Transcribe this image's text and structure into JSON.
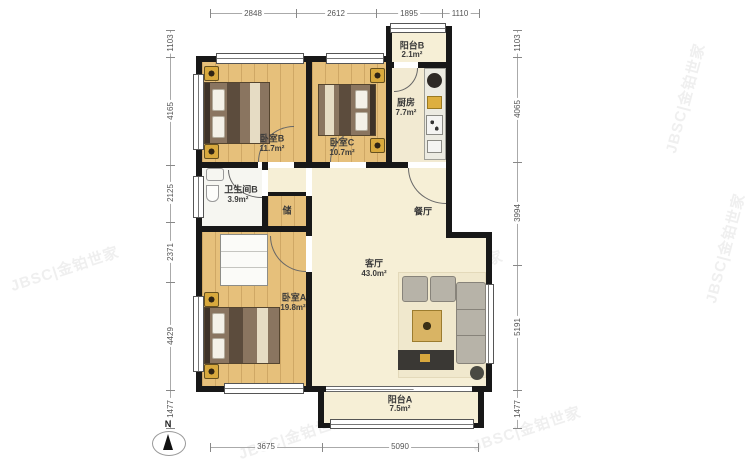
{
  "watermark": {
    "text": "JBSC|金铂世家"
  },
  "compass": {
    "north_label": "N"
  },
  "dimensions": {
    "top": [
      "2848",
      "2612",
      "1895",
      "1110"
    ],
    "left": [
      "1103",
      "4165",
      "2125",
      "2371",
      "4429",
      "1477"
    ],
    "right": [
      "1103",
      "4065",
      "3994",
      "5191",
      "1477"
    ],
    "bottom": [
      "3675",
      "5090"
    ]
  },
  "rooms": {
    "balcony_b": {
      "name": "阳台B",
      "area": "2.1m²"
    },
    "kitchen": {
      "name": "厨房",
      "area": "7.7m²"
    },
    "bedroom_b": {
      "name": "卧室B",
      "area": "11.7m²"
    },
    "bedroom_c": {
      "name": "卧室C",
      "area": "10.7m²"
    },
    "bathroom": {
      "name": "卫生间B",
      "area": "3.9m²"
    },
    "storage": {
      "name": "储"
    },
    "dining": {
      "name": "餐厅"
    },
    "living": {
      "name": "客厅",
      "area": "43.0m²"
    },
    "bedroom_a": {
      "name": "卧室A",
      "area": "19.8m²"
    },
    "balcony_a": {
      "name": "阳台A",
      "area": "7.5m²"
    }
  }
}
